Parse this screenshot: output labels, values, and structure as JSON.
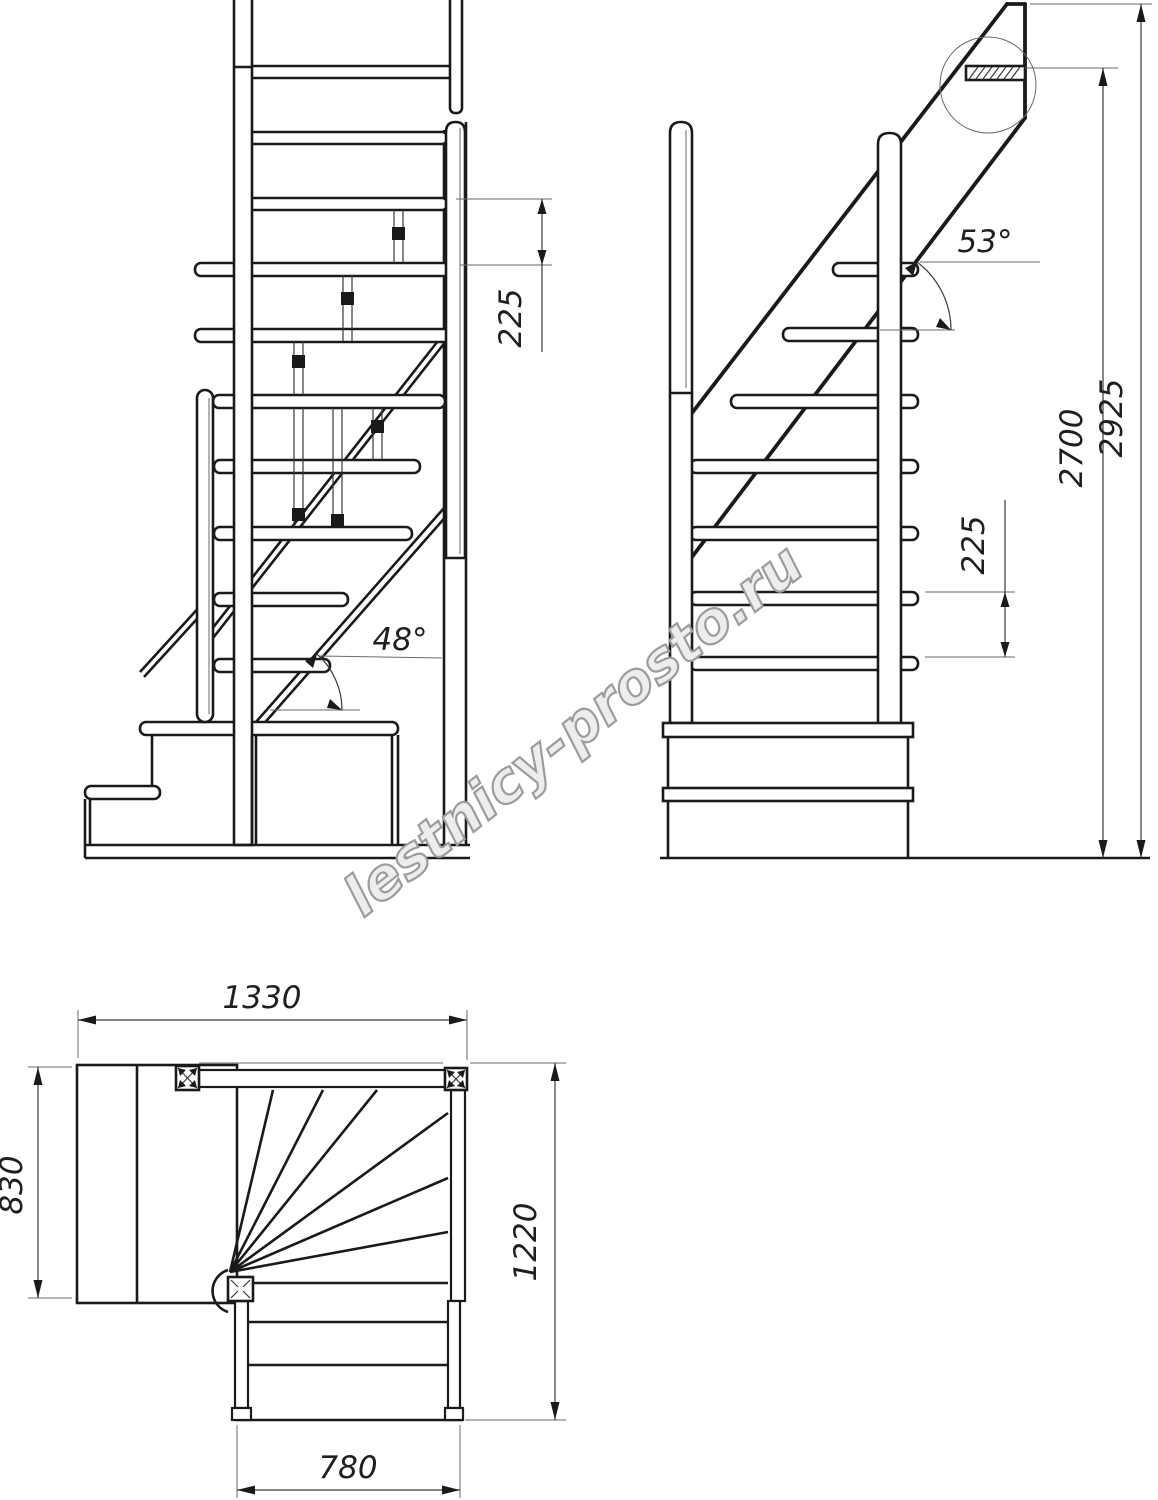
{
  "watermark": {
    "text": "lestnicy-prosto.ru"
  },
  "front_view": {
    "riser_dim": "225",
    "slope_angle": "48°"
  },
  "side_view": {
    "slope_angle": "53°",
    "riser_dim": "225",
    "floor_height": "2700",
    "overall_height": "2925"
  },
  "plan_view": {
    "overall_width": "1330",
    "landing_depth": "830",
    "stair_depth": "1220",
    "flight_width": "780"
  }
}
